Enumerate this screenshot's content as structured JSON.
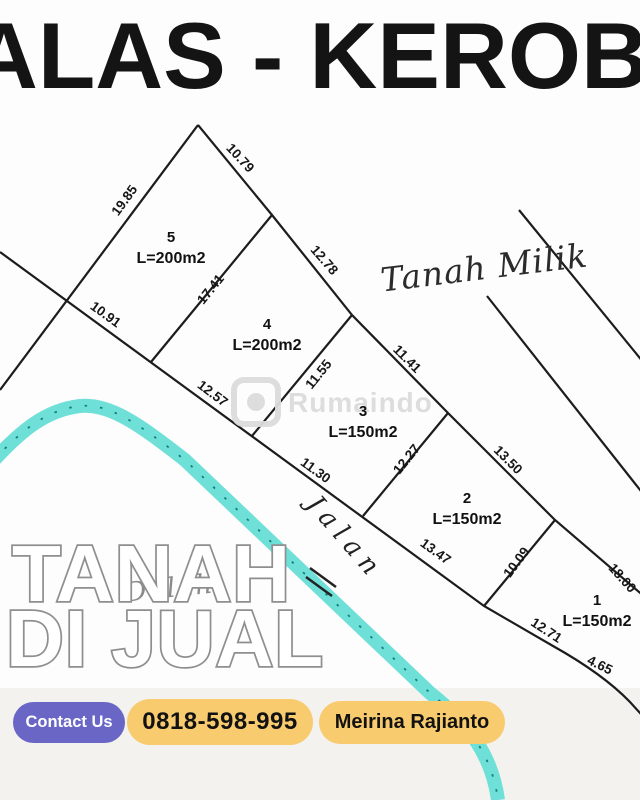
{
  "header": {
    "title": "ALAS - KEROB"
  },
  "map": {
    "parcel_owner_label": "Tanah Milik",
    "road_label": "Jalan",
    "background_script": "Dalah",
    "plots": [
      {
        "number": "1",
        "area": "L=150m2"
      },
      {
        "number": "2",
        "area": "L=150m2"
      },
      {
        "number": "3",
        "area": "L=150m2"
      },
      {
        "number": "4",
        "area": "L=200m2"
      },
      {
        "number": "5",
        "area": "L=200m2"
      }
    ],
    "dimensions": [
      "10.79",
      "19.85",
      "17.41",
      "10.91",
      "12.78",
      "12.57",
      "11.55",
      "11.41",
      "11.30",
      "12.27",
      "13.50",
      "13.47",
      "10.09",
      "18.00",
      "12.71",
      "4.65"
    ],
    "road_color": "#6fe0d8",
    "road_dot_color": "#157f7a",
    "line_color": "#1c1c1c"
  },
  "watermark": {
    "text": "Rumaindo"
  },
  "sale_overlay": {
    "line1": "TANAH",
    "line2": "DI JUAL"
  },
  "footer": {
    "contact_button": "Contact Us",
    "phone": "0818-598-995",
    "agent_name": "Meirina Rajianto",
    "contact_color": "#6966c6",
    "pill_color": "#f8cb6f"
  }
}
